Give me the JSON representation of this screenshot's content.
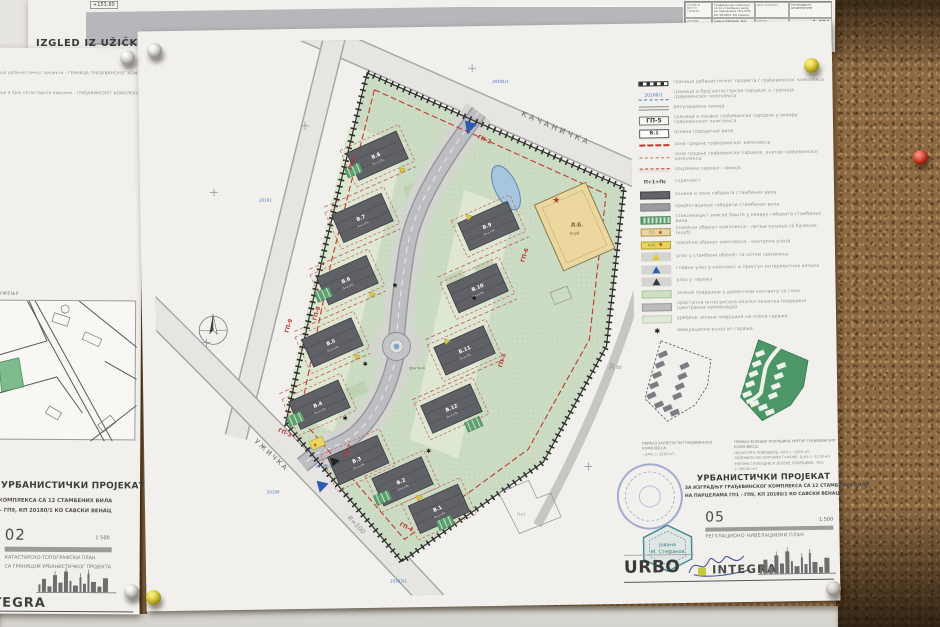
{
  "colors": {
    "paper": "#f1f0ec",
    "cork": "#8d6a43",
    "plan_green": "#ccdcc4",
    "building_gray": "#606167",
    "club_yellow": "#ecd79f",
    "pool_blue": "#a6c6e0",
    "boundary_red": "#c0392b",
    "cadastral_blue": "#4a6fc0",
    "logo_square": "#c6c93a"
  },
  "top_sheet": {
    "elevation_label": "+153.60",
    "caption": "IZGLED IZ UŽIČKE UL. 5",
    "titleblock": {
      "rows": [
        {
          "label": "НАЗИВ И МЕСТО ГРАДЊЕ",
          "value": "Грађевински комплекс са 12 стамбених вила на парцелама ГП1-ГП9, КП 20180/1 КО Савски венац"
        },
        {
          "label": "АУТОРИ",
          "value": "Јована Лабовић, диа · Александра Грујичић, диа"
        },
        {
          "label": "ОДГОВОРНИ ПРОЈЕКТАНТ",
          "value": "Александра Грујичић, диа"
        }
      ],
      "part_label": "ДЕО ПРОЈЕКТА",
      "part_value": "УП ПРОЈЕКАТ АРХИТЕКТУРЕ",
      "drawing_label": "ЦРТЕЖ",
      "drawing_value": "ПРЕСЕЦИ - ИЗГЛЕДИ",
      "scale_label": "Р",
      "scale_value": "1:250",
      "date_label": "ДАТУМ",
      "date_value": "МАРТ 2015.",
      "sheet_label": "ЛИСТ БР.",
      "sheet_value": "09"
    }
  },
  "left_sheet": {
    "legend_lines": [
      "граница урбанистичког пројекта - ГРАНИЦА ГРАЂЕВИНСКОГ КОМПЛЕКСА",
      "граница и број катастарске парцеле - ГРАЂЕВИНСКОГ КОМПЛЕКСА"
    ],
    "map_heading": "М ОКРУЖЕЊУ",
    "title": "УРБАНИСТИЧКИ ПРОЈЕКАТ",
    "subtitle_line1": "СКОГ КОМПЛЕКСА СА 12 СТАМБЕНИХ ВИЛА",
    "subtitle_line2": "А ГП1 - ГП9,  КП 20180/1 КО САВСКИ ВЕНАЦ",
    "sheet_number": "02",
    "scale": "1 500",
    "drawing_name_line1": "КАТАСТАРСКО-ТОПОГРАФСКИ ПЛАН",
    "drawing_name_line2": "СА ГРАНИЦОМ УРБАНИСТИЧКОГ ПРОЈЕКТА",
    "logo_fragment": "TEGRA"
  },
  "main_sheet": {
    "plan": {
      "street_top": "КАЧАНИЧКА",
      "street_bottom": "УЖИЧКА",
      "radius_label": "R=100",
      "radius_label2": "R=",
      "buildings": [
        "В.8",
        "В.7",
        "В.6",
        "В.5",
        "В.4",
        "В.9",
        "В.10",
        "В.11",
        "В.12",
        "В.3",
        "В.2",
        "В.1"
      ],
      "storeys_label": "П+1+Пс",
      "club_label": "Л.б.",
      "club_sublabel": "Клуб",
      "kos_label": "КОС",
      "fountain_label": "фонтана",
      "neighbor_label": "П+1",
      "parcels": [
        "ГП-1",
        "ГП-2",
        "ГП-3",
        "ГП-4",
        "ГП-5",
        "ГП-6",
        "ГП-7",
        "ГП-8",
        "ГП-9"
      ],
      "cadastral_numbers": [
        "20192",
        "20181/1",
        "20180/1",
        "20190",
        "20183/1"
      ]
    },
    "legend": {
      "items": [
        {
          "symbol": "boundary",
          "text": "граница урбанистичког пројекта / грађевинског комплекса"
        },
        {
          "symbol": "cadnum",
          "symbol_text": "20180/1",
          "text": "граница и број катастарске парцеле + граница грађевинског комплекса"
        },
        {
          "symbol": "regline",
          "text": "регулациона линија"
        },
        {
          "symbol": "gp",
          "symbol_text": "ГП-5",
          "text": "граница и ознака грађевинске парцеле у оквиру грађевинског комплекса"
        },
        {
          "symbol": "villa",
          "symbol_text": "В.1",
          "text": "ознака породичне виле"
        },
        {
          "symbol": "redzone",
          "text": "зона градње грађевинског комплекса"
        },
        {
          "symbol": "redzone2",
          "text": "зона градње грађевинске парцеле, унутар грађевинског комплекса"
        },
        {
          "symbol": "garline",
          "text": "подземна гаража - линија"
        },
        {
          "symbol": "storeys",
          "symbol_text": "П+1+Пс",
          "text": "спратност"
        },
        {
          "symbol": "darkgray",
          "text": "ознака и зона габарита стамбених вила"
        },
        {
          "symbol": "gray",
          "text": "оријентациони габарити стамбених вила"
        },
        {
          "symbol": "greenhatch",
          "text": "стакленици / зимске баште у оквиру габарита стамбених вила"
        },
        {
          "symbol": "club",
          "symbol_text": "Л.б.",
          "text": "помоћни објекат комплекса - летња кухиња са базеном (клуб)"
        },
        {
          "symbol": "kos",
          "symbol_text": "КОС",
          "text": "помоћни објекат комплекса - контрола улаза"
        },
        {
          "symbol": "tri-y",
          "text": "улаз у стамбени објекат са котом приземља"
        },
        {
          "symbol": "tri-b",
          "text": "главни улаз у комплекс и приступ интервентних возила"
        },
        {
          "symbol": "tri-k",
          "text": "улаз у гаражу"
        },
        {
          "symbol": "lgreen",
          "text": "зелене површине у директном контакту са тлом"
        },
        {
          "symbol": "gray2",
          "text": "приступна интегрисана колско-пешачка површина (централна променада)"
        },
        {
          "symbol": "pgreen",
          "text": "уређене зелене површине на плочи гараже"
        },
        {
          "symbol": "star",
          "text": "евакуациони излаз из гараже"
        }
      ]
    },
    "diagrams": {
      "left_note_line1": "ПРИКАЗ ЗАУЗЕТОСТИ ГРАЂЕВИНСКОГ КОМПЛЕКСА:",
      "left_note_line2": "~24% (~3326 м²)",
      "right_note": "ПРИКАЗ ЗЕЛЕНИХ ПОВРШИНА УНУТАР ГРАЂЕВИНСКОГ КОМПЛЕКСА:",
      "right_bullets": [
        "НЕЗАСТРТЕ ПОВРШИНЕ: 40% (~5840 м²)",
        "ЗЕЛЕНИЛО НА ПЛОЧАМА ГАРАЖЕ: 8,4% (~1178 м²)",
        "УКУПНЕ СЛОБОДНЕ И ЗЕЛЕНЕ ПОВРШИНЕ: 76% (~10032 м²)"
      ]
    },
    "titleblock": {
      "title": "УРБАНИСТИЧКИ ПРОЈЕКАТ",
      "subtitle_line1": "ЗА ИЗГРАДЊУ ГРАЂЕВИНСКОГ КОМПЛЕКСА СА 12 СТАМБЕНИХ ВИЛА",
      "subtitle_line2": "НА ПАРЦЕЛАМА ГП1 - ГП9,  КП 20180/1 КО САВСКИ ВЕНАЦ",
      "sheet_number": "05",
      "scale": "1:500",
      "drawing_name": "РЕГУЛАЦИОНО НИВЕЛАЦИОНИ ПЛАН",
      "stamp_name_line1": "Јована",
      "stamp_name_line2": "М. Стефанов",
      "logo_urbo": "URBO",
      "logo_integra": "INTEGRA"
    }
  },
  "pins": [
    {
      "color": "white",
      "x": 120,
      "y": 50
    },
    {
      "color": "white",
      "x": 147,
      "y": 43
    },
    {
      "color": "yellow",
      "x": 804,
      "y": 58
    },
    {
      "color": "red",
      "x": 913,
      "y": 150
    },
    {
      "color": "white",
      "x": 124,
      "y": 584
    },
    {
      "color": "yellow",
      "x": 146,
      "y": 590
    },
    {
      "color": "gray",
      "x": 826,
      "y": 581
    }
  ]
}
